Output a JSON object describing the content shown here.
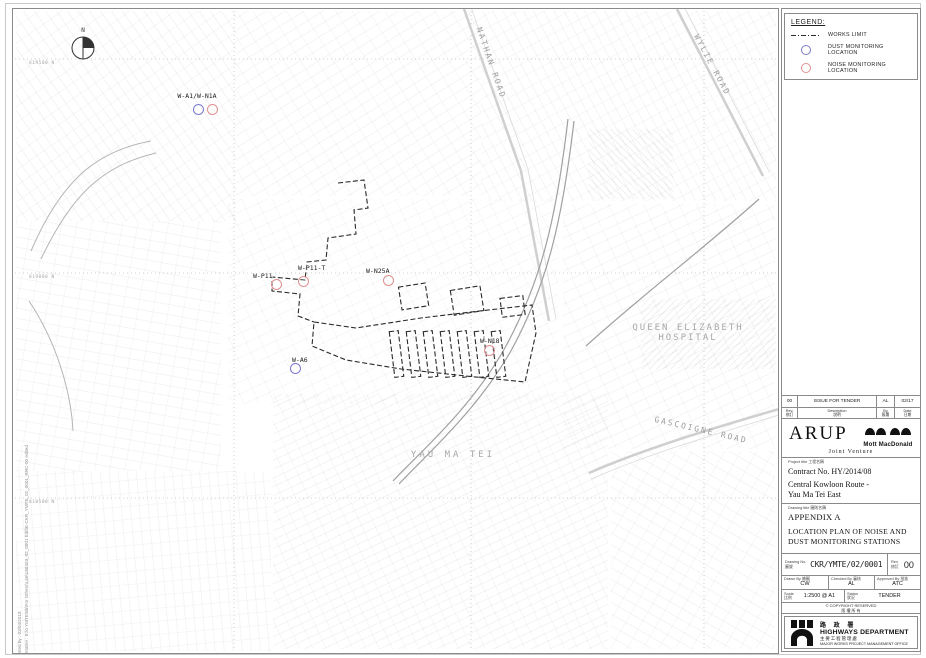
{
  "colors": {
    "dust": "#7b7bd0",
    "noise": "#e09090",
    "works_limit": "#2a2a2a"
  },
  "map": {
    "north_label": "N",
    "grid_labels": [
      "819500 N",
      "819000 N",
      "818500 N"
    ],
    "roads": [
      "NATHAN ROAD",
      "WYLIE ROAD",
      "GASCOIGNE ROAD"
    ],
    "places": {
      "hospital_line1": "QUEEN ELIZABETH",
      "hospital_line2": "HOSPITAL",
      "district": "YAU MA TEI"
    },
    "stations": [
      {
        "id": "W-A1/W-N1A"
      },
      {
        "id": "W-P11"
      },
      {
        "id": "W-P11-T"
      },
      {
        "id": "W-N25A"
      },
      {
        "id": "W-N18"
      },
      {
        "id": "W-A6"
      }
    ],
    "print_note_line1": "Printed by :  03/04/2018",
    "print_note_line2": "Filename :  E:\\0 YMTE\\6b\\For Others\\L4e\\180423_02_0001 Edit\\E-CKR_YMTE_02_0001_RRC-00 edited A.dgn"
  },
  "legend": {
    "title": "LEGEND:",
    "items": [
      {
        "label": "WORKS LIMIT"
      },
      {
        "label": "DUST MONITORING LOCATION"
      },
      {
        "label": "NOISE MONITORING LOCATION"
      }
    ]
  },
  "title_block": {
    "revision": {
      "rev": "00",
      "description": "ISSUE FOR TENDER",
      "by": "AL",
      "date": "02/17"
    },
    "revision_header": {
      "rev_en": "Rev.",
      "rev_cn": "修訂",
      "desc_en": "Description",
      "desc_cn": "說明",
      "by_en": "By",
      "by_cn": "簽署",
      "date_en": "Date",
      "date_cn": "日期"
    },
    "firms": {
      "arup": "ARUP",
      "mott": "Mott MacDonald",
      "joint_venture": "Joint Venture"
    },
    "project": {
      "label_en": "Project title",
      "label_cn": "工程名稱",
      "contract": "Contract No. HY/2014/08",
      "name_line1": "Central Kowloon Route -",
      "name_line2": "Yau Ma Tei East"
    },
    "drawing": {
      "label_en": "Drawing title",
      "label_cn": "圖則名稱",
      "appendix": "APPENDIX A",
      "title_line1": "LOCATION PLAN OF NOISE AND",
      "title_line2": "DUST MONITORING STATIONS"
    },
    "numbers": {
      "no_label_en": "Drawing No.",
      "no_label_cn": "圖號",
      "drawing_no": "CKR/YMTE/02/0001",
      "rev_label_en": "Rev.",
      "rev_label_cn": "修訂",
      "rev": "00"
    },
    "people": {
      "drawn_en": "Drawn By",
      "drawn_cn": "繪圖",
      "drawn": "CW",
      "checked_en": "Checked By",
      "checked_cn": "審核",
      "checked": "AL",
      "approved_en": "Approved By",
      "approved_cn": "批准",
      "approved": "ATC"
    },
    "scale_status": {
      "scale_en": "Scale",
      "scale_cn": "比例",
      "scale": "1:2500 @ A1",
      "status_en": "Status",
      "status_cn": "狀況",
      "status": "TENDER"
    },
    "copyright_en": "© COPYRIGHT RESERVED",
    "copyright_cn": "版 權 所 有",
    "department": {
      "name_cn": "路 政 署",
      "name_en": "HIGHWAYS DEPARTMENT",
      "office_cn": "主要工程管理處",
      "office_en": "MAJOR WORKS PROJECT MANAGEMENT OFFICE"
    }
  }
}
